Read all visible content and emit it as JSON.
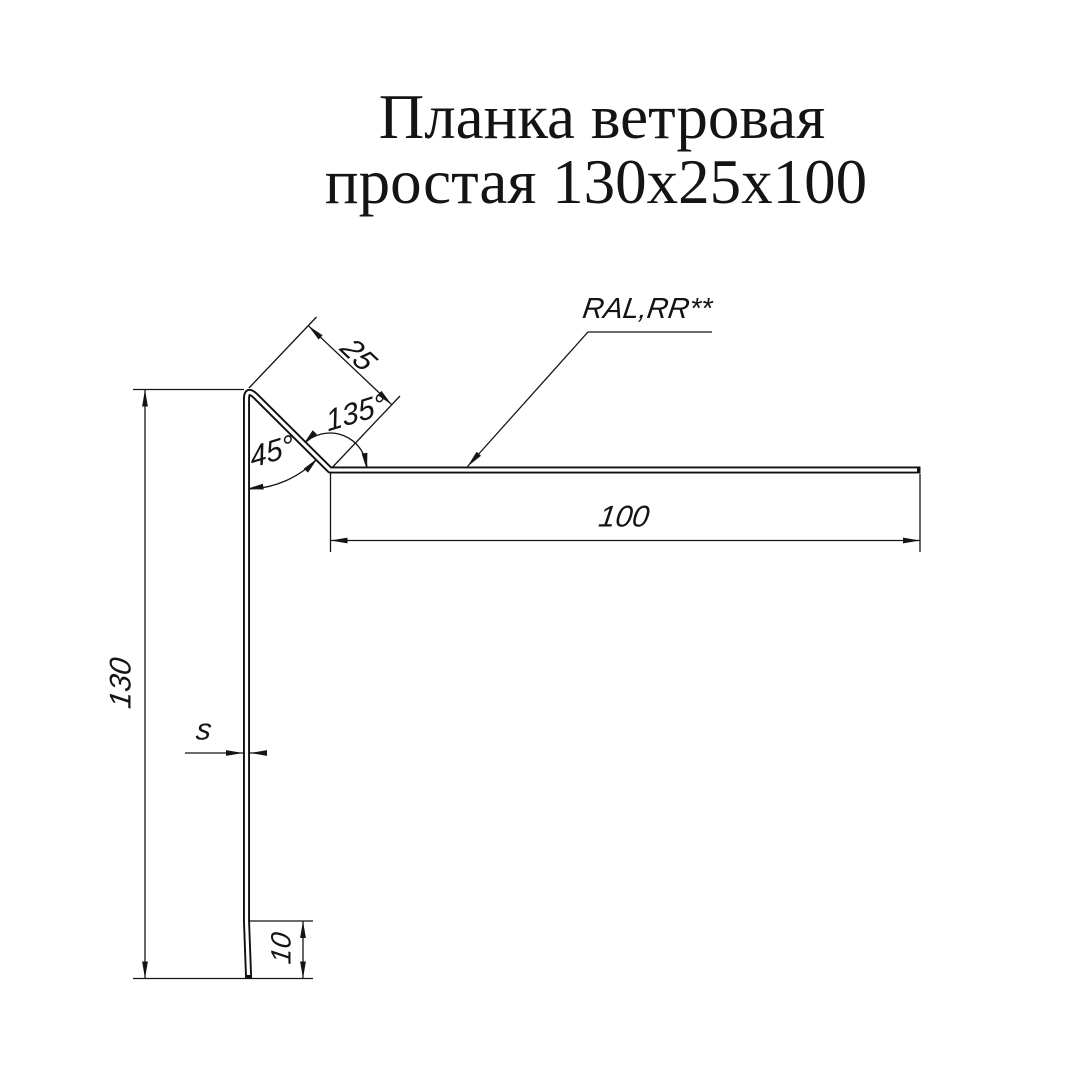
{
  "title": {
    "line1": "Планка ветровая",
    "line2": "простая 130x25x100"
  },
  "labels": {
    "coating": "RAL,RR**",
    "dim_height": "130",
    "dim_flange": "25",
    "angle_top": "135°",
    "angle_side": "45°",
    "dim_width": "100",
    "dim_thickness": "s",
    "dim_hem": "10"
  }
}
